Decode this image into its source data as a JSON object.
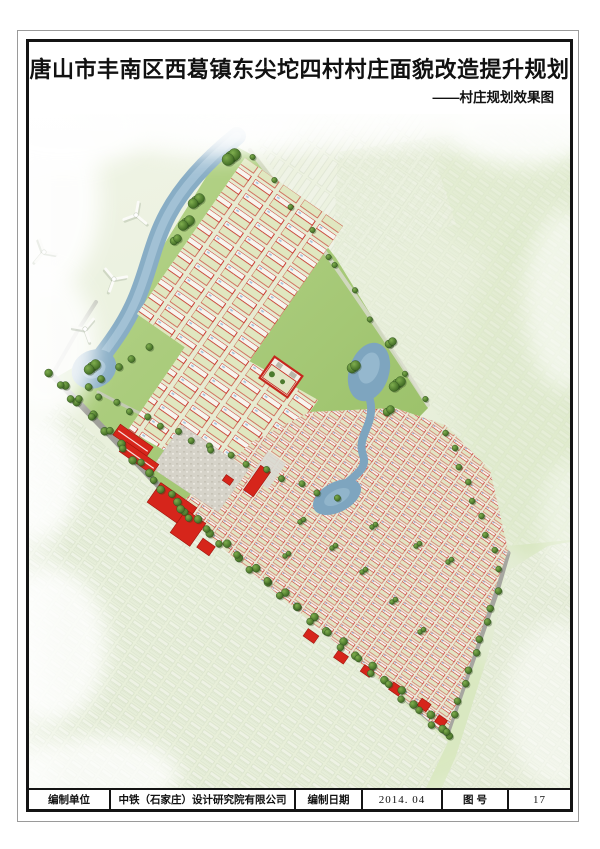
{
  "header": {
    "title": "唐山市丰南区西葛镇东尖坨四村村庄面貌改造提升规划",
    "subtitle": "——村庄规划效果图"
  },
  "title_block": {
    "cells": [
      {
        "text": "编制单位"
      },
      {
        "text": "中铁（石家庄）设计研究院有限公司"
      },
      {
        "text": "编制日期"
      },
      {
        "text": "2014. 04"
      },
      {
        "text": "图 号"
      },
      {
        "text": "17"
      }
    ]
  },
  "map": {
    "caption": "村庄规划鸟瞰效果图",
    "colors": {
      "building_red": "#d6251b",
      "house_outline_red": "#c5261d",
      "water": "#88adc5",
      "road_gray": "#9f9f99",
      "tree_green": "#47722b",
      "meadow_green": "#a5c873"
    },
    "wind_turbines": [
      {
        "x": 136,
        "y": 215,
        "rot": 10
      },
      {
        "x": 114,
        "y": 279,
        "rot": 80
      },
      {
        "x": 85,
        "y": 329,
        "rot": 40
      },
      {
        "x": 44,
        "y": 252,
        "rot": 100,
        "faint": true
      }
    ],
    "tree_lines": [
      [
        50,
        372,
        176,
        503,
        10,
        4
      ],
      [
        62,
        384,
        186,
        511,
        9,
        3.5
      ],
      [
        182,
        508,
        444,
        728,
        19,
        4
      ],
      [
        190,
        517,
        448,
        737,
        18,
        3.5
      ],
      [
        448,
        731,
        497,
        592,
        10,
        3.5
      ],
      [
        500,
        568,
        447,
        432,
        9,
        3
      ],
      [
        100,
        396,
        208,
        447,
        8,
        3.2
      ],
      [
        212,
        449,
        336,
        499,
        8,
        3.2
      ],
      [
        72,
        398,
        148,
        348,
        6,
        3.6
      ],
      [
        254,
        156,
        330,
        256,
        5,
        2.8
      ],
      [
        336,
        264,
        424,
        400,
        6,
        2.8
      ]
    ],
    "tree_clumps": [
      [
        231,
        157,
        6,
        3
      ],
      [
        196,
        201,
        5,
        3
      ],
      [
        186,
        223,
        5,
        3
      ],
      [
        174,
        241,
        4,
        2
      ],
      [
        92,
        367,
        5,
        3
      ],
      [
        352,
        368,
        5,
        2
      ],
      [
        389,
        344,
        4,
        2
      ],
      [
        397,
        384,
        5,
        3
      ],
      [
        387,
        412,
        4,
        2
      ],
      [
        300,
        522,
        2.5,
        2
      ],
      [
        332,
        548,
        2.5,
        2
      ],
      [
        362,
        572,
        2.5,
        2
      ],
      [
        392,
        602,
        2.5,
        2
      ],
      [
        285,
        556,
        2.5,
        2
      ],
      [
        420,
        632,
        2.5,
        2
      ],
      [
        372,
        527,
        2.5,
        2
      ],
      [
        448,
        562,
        2.5,
        2
      ],
      [
        416,
        546,
        2.5,
        2
      ]
    ],
    "red_buildings": [
      {
        "x": 133,
        "y": 441,
        "w": 40,
        "h": 13,
        "s": 1
      },
      {
        "x": 139,
        "y": 458,
        "w": 40,
        "h": 12,
        "s": 1
      },
      {
        "x": 257,
        "y": 481,
        "w": 12,
        "h": 30
      },
      {
        "x": 172,
        "y": 505,
        "w": 44,
        "h": 24
      },
      {
        "x": 188,
        "y": 528,
        "w": 24,
        "h": 28
      },
      {
        "x": 206,
        "y": 547,
        "w": 15,
        "h": 11
      },
      {
        "x": 228,
        "y": 480,
        "w": 9,
        "h": 7
      },
      {
        "x": 311,
        "y": 636,
        "w": 13,
        "h": 9
      },
      {
        "x": 341,
        "y": 657,
        "w": 12,
        "h": 9
      },
      {
        "x": 367,
        "y": 671,
        "w": 11,
        "h": 8
      },
      {
        "x": 396,
        "y": 689,
        "w": 12,
        "h": 9
      },
      {
        "x": 424,
        "y": 705,
        "w": 11,
        "h": 9
      },
      {
        "x": 441,
        "y": 721,
        "w": 10,
        "h": 8
      }
    ]
  }
}
